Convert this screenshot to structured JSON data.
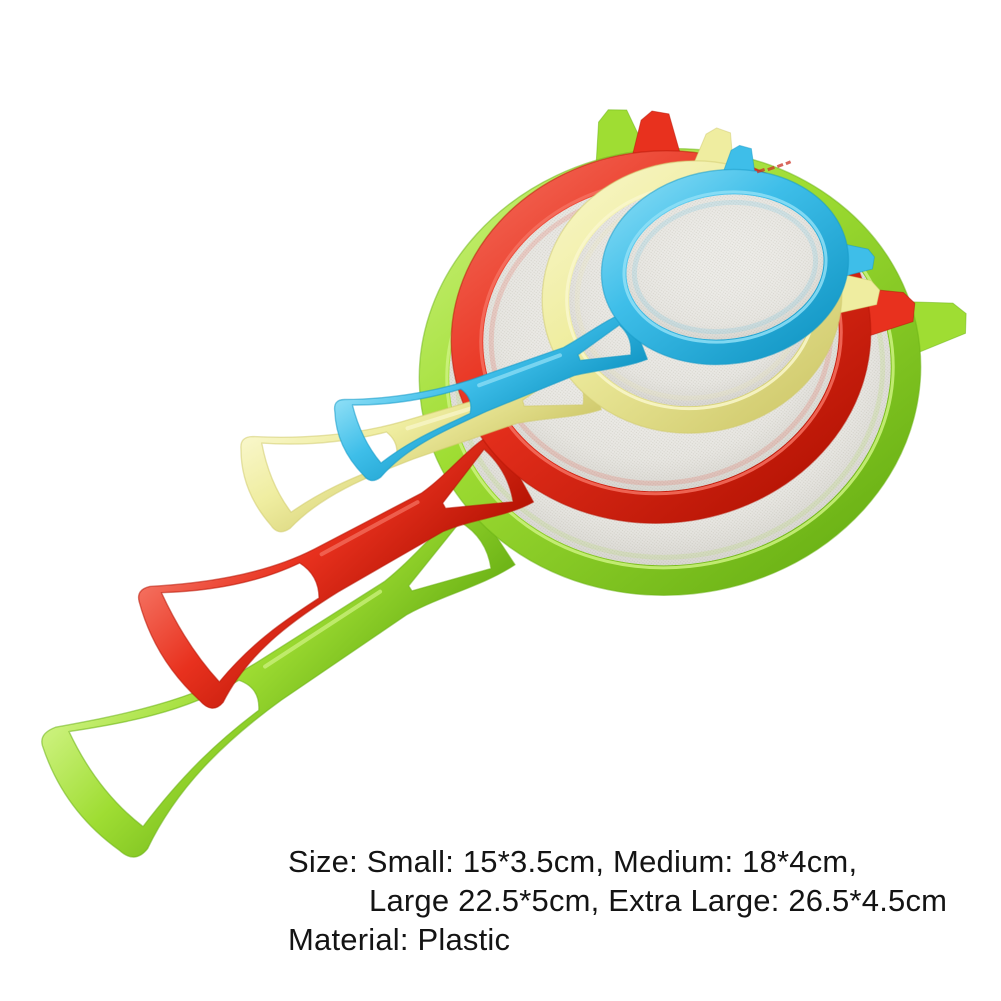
{
  "background": "#ffffff",
  "caption": {
    "line1": "Size: Small: 15*3.5cm, Medium: 18*4cm,",
    "line2": "Large 22.5*5cm, Extra Large: 26.5*4.5cm",
    "line3": "Material: Plastic",
    "text_color": "#141414"
  },
  "mesh": {
    "fill": "#edece8",
    "dot": "#d8d6ce"
  },
  "stamp": {
    "color": "#cc3326",
    "x": 757,
    "y": 172,
    "rot": -12
  },
  "strainers": [
    {
      "name": "green",
      "size": "extra-large 26.5*4.5cm",
      "colors": {
        "base": "#9fdd33",
        "light": "#cdf27f",
        "dark": "#6cb316"
      },
      "bowl": {
        "cx": 670,
        "cy": 372,
        "rx": 251,
        "ry": 223,
        "tilt": -6,
        "ring": 30
      },
      "handle": {
        "ax": 494,
        "ay": 533,
        "angle": 33.5,
        "len": 490,
        "forkHalf": 38,
        "shaftHalf": 20,
        "tipHalf": 80,
        "wall": 11
      },
      "tabs": [
        {
          "deg": -96,
          "len": 50,
          "baseHalf": 26,
          "tipHalf": 15
        },
        {
          "deg": -5,
          "len": 55,
          "baseHalf": 26,
          "tipHalf": 16
        }
      ]
    },
    {
      "name": "red",
      "size": "large 22.5*5cm",
      "colors": {
        "base": "#e8311e",
        "light": "#f4705f",
        "dark": "#b81505"
      },
      "bowl": {
        "cx": 661,
        "cy": 337,
        "rx": 210,
        "ry": 186,
        "tilt": -6,
        "ring": 32
      },
      "handle": {
        "ax": 514,
        "ay": 467,
        "angle": 29,
        "len": 390,
        "forkHalf": 40,
        "shaftHalf": 22,
        "tipHalf": 72,
        "wall": 11
      },
      "tabs": [
        {
          "deg": -86,
          "len": 44,
          "baseHalf": 24,
          "tipHalf": 14
        },
        {
          "deg": -1,
          "len": 50,
          "baseHalf": 24,
          "tipHalf": 15
        }
      ]
    },
    {
      "name": "yellow",
      "size": "medium 18*4cm",
      "colors": {
        "base": "#efeda0",
        "light": "#f9f7cb",
        "dark": "#d2cc70"
      },
      "bowl": {
        "cx": 692,
        "cy": 297,
        "rx": 150,
        "ry": 136,
        "tilt": -6,
        "ring": 27
      },
      "handle": {
        "ax": 592,
        "ay": 381,
        "angle": 18,
        "len": 352,
        "forkHalf": 30,
        "shaftHalf": 17,
        "tipHalf": 52,
        "wall": 9
      },
      "tabs": [
        {
          "deg": -76,
          "len": 38,
          "baseHalf": 20,
          "tipHalf": 12
        },
        {
          "deg": 5,
          "len": 42,
          "baseHalf": 20,
          "tipHalf": 12
        }
      ]
    },
    {
      "name": "blue",
      "size": "small 15*3.5cm",
      "colors": {
        "base": "#3ebee9",
        "light": "#8fdff6",
        "dark": "#169ac8"
      },
      "bowl": {
        "cx": 725,
        "cy": 267,
        "rx": 124,
        "ry": 97,
        "tilt": -8,
        "ring": 25
      },
      "handle": {
        "ax": 638,
        "ay": 335,
        "angle": 21,
        "len": 308,
        "forkHalf": 26,
        "shaftHalf": 15,
        "tipHalf": 45,
        "wall": 8
      },
      "tabs": [
        {
          "deg": -77,
          "len": 28,
          "baseHalf": 16,
          "tipHalf": 10
        },
        {
          "deg": 6,
          "len": 30,
          "baseHalf": 16,
          "tipHalf": 10
        }
      ]
    }
  ]
}
